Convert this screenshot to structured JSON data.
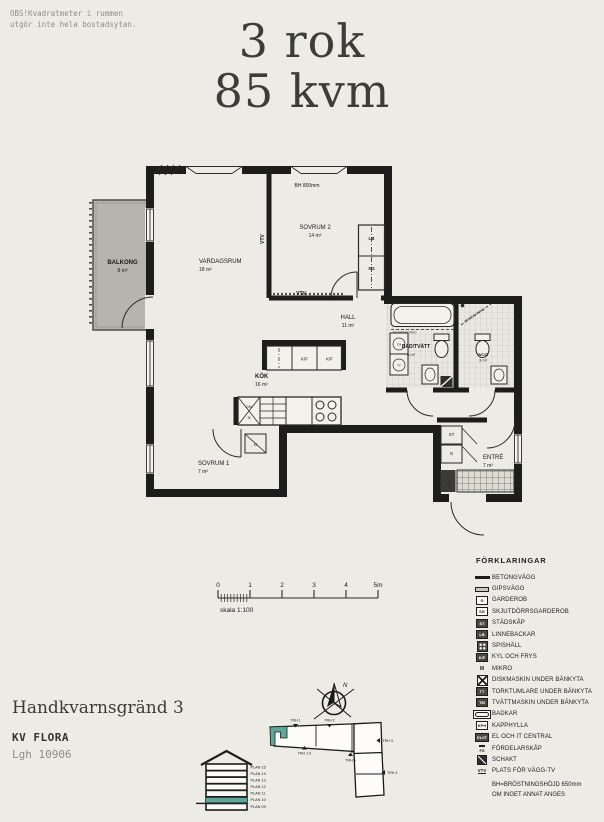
{
  "note": {
    "line1": "OBS!Kvadratmeter i rummen",
    "line2": "utgör inte hela bostadsytan."
  },
  "title": {
    "line1": "3 rok",
    "line2": "85 kvm"
  },
  "plan": {
    "rooms": {
      "balkong": {
        "name": "BALKONG",
        "area": "8 m²"
      },
      "vardagsrum": {
        "name": "VARDAGSRUM",
        "area": "18 m²"
      },
      "sovrum2": {
        "name": "SOVRUM 2",
        "area": "14 m²"
      },
      "hall": {
        "name": "HALL",
        "area": "11 m²"
      },
      "kok": {
        "name": "KÖK",
        "area": "16 m²"
      },
      "sovrum1": {
        "name": "SOVRUM 1",
        "area": "7 m²"
      },
      "entre": {
        "name": "ENTRÉ",
        "area": "7 m²"
      },
      "badtvatt": {
        "name": "BAD/TVÄTT",
        "area": "6 m²"
      },
      "wcd": {
        "name": "WC/D",
        "area": "3 m²"
      }
    },
    "labels": {
      "bh": "BH 800mm",
      "vtv": "VTV",
      "lb": "LB",
      "sg": "SG",
      "st": "ST",
      "g": "G",
      "kf": "K/F",
      "dm": "DM",
      "m": "M",
      "tm": "TM",
      "tt": "TT",
      "elit": "EL/IT",
      "draperistang": "DRAPERISTÅNG"
    }
  },
  "scalebar": {
    "ticks": [
      "0",
      "1",
      "2",
      "3",
      "4",
      "5m"
    ],
    "caption": "skala 1:100"
  },
  "legend": {
    "title": "FÖRKLARINGAR",
    "items": [
      {
        "label": "BETONGVÄGG"
      },
      {
        "label": "GIPSVÄGG"
      },
      {
        "text": "G",
        "label": "GARDEROB"
      },
      {
        "text": "SG",
        "label": "SKJUTDÖRRSGARDEROB"
      },
      {
        "text": "ST",
        "label": "STÄDSKÅP"
      },
      {
        "text": "LB",
        "label": "LINNEBACKAR"
      },
      {
        "label": "SPISHÄLL"
      },
      {
        "text": "K/F",
        "label": "KYL OCH FRYS"
      },
      {
        "text": "M",
        "label": "MIKRO"
      },
      {
        "label": "DISKMASKIN UNDER BÄNKYTA"
      },
      {
        "text": "TT",
        "label": "TORKTUMLARE UNDER BÄNKYTA"
      },
      {
        "text": "TM",
        "label": "TVÄTTMASKIN UNDER BÄNKYTA"
      },
      {
        "label": "BADKAR"
      },
      {
        "text": "KPH",
        "label": "KAPPHYLLA"
      },
      {
        "text": "EL/IT",
        "label": "EL OCH IT CENTRAL"
      },
      {
        "text": "FS",
        "label": "FÖRDELARSKÅP"
      },
      {
        "label": "SCHAKT"
      },
      {
        "text": "VTV",
        "label": "PLATS FÖR VÄGG-TV"
      }
    ],
    "footnote1": "BH=BRÖSTNINGSHÖJD 650mm",
    "footnote2": "OM INGET ANNAT ANGES"
  },
  "address": {
    "street": "Handkvarnsgränd 3",
    "block": "KV FLORA",
    "apartment": "Lgh 10906"
  },
  "site_plan": {
    "north": "N",
    "stairwells": [
      "TRH 1",
      "TRH 2",
      "TRH 3",
      "TRH 4",
      "TRH 5",
      "TRH 1-2"
    ]
  },
  "elevation": {
    "floors": [
      "PLAN 15",
      "PLAN 14",
      "PLAN 13",
      "PLAN 12",
      "PLAN 11",
      "PLAN 10",
      "PLAN 09"
    ],
    "highlighted_floor": "PLAN 10"
  },
  "colors": {
    "background": "#ecebe6",
    "wall": "#1d1d1b",
    "accent_teal": "#5ea89b",
    "balcony_fill": "#b5b4ae"
  }
}
